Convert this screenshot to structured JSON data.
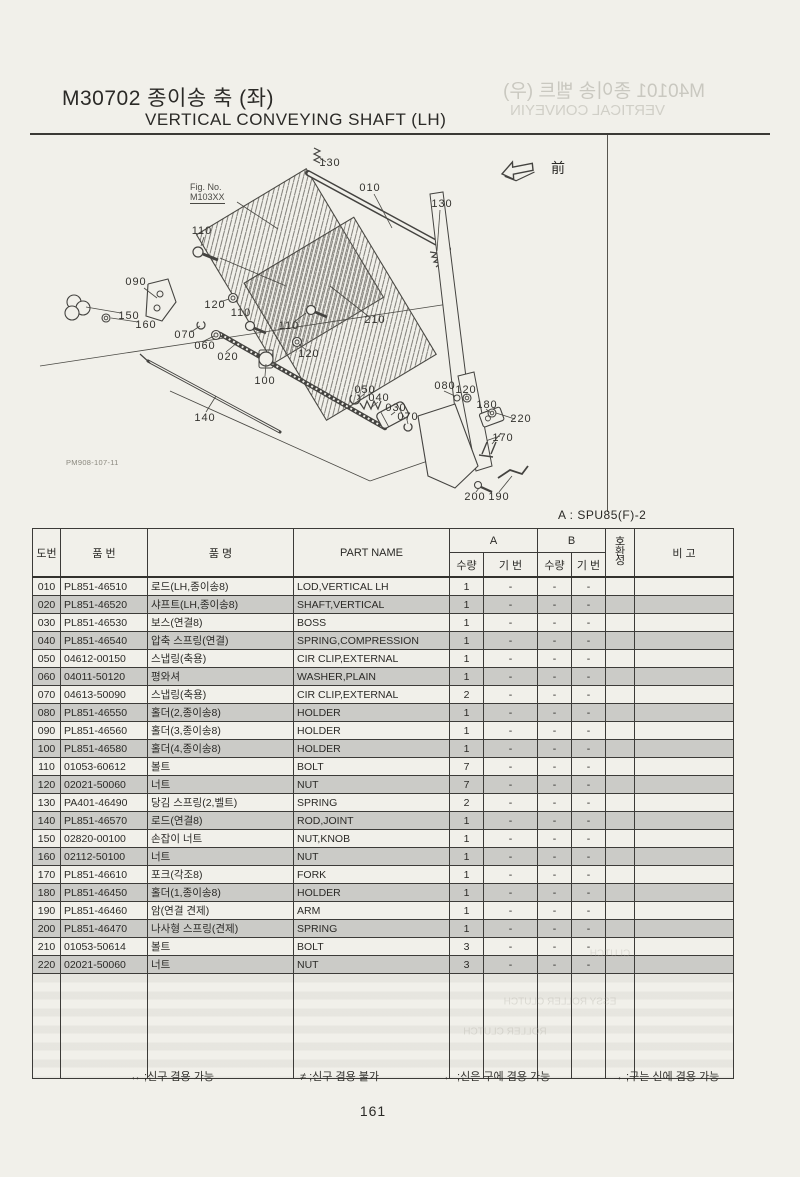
{
  "header": {
    "code_title": "M30702 종이송 축 (좌)",
    "subtitle": "VERTICAL CONVEYING SHAFT (LH)"
  },
  "ghost": {
    "title": "M40101 종이송 벨트 (우)",
    "subtitle": "VERTICAL CONVEYIN",
    "table_snippets": [
      {
        "text": "ESSY ROLLER CLUTCH",
        "x": 560,
        "y": 1002
      },
      {
        "text": "CLUTCH",
        "x": 610,
        "y": 954
      },
      {
        "text": "ROLLER CLUTCH",
        "x": 505,
        "y": 1032
      }
    ]
  },
  "diagram": {
    "fig_no_label": "Fig. No.",
    "fig_no": "M103XX",
    "doc_code": "PM908-107-11",
    "direction_label": "前",
    "callouts": [
      {
        "label": "130",
        "x": 300,
        "y": 27
      },
      {
        "label": "010",
        "x": 340,
        "y": 52
      },
      {
        "label": "130",
        "x": 412,
        "y": 68
      },
      {
        "label": "110",
        "x": 172,
        "y": 95
      },
      {
        "label": "090",
        "x": 106,
        "y": 146
      },
      {
        "label": "120",
        "x": 185,
        "y": 169
      },
      {
        "label": "110",
        "x": 211,
        "y": 177
      },
      {
        "label": "150",
        "x": 99,
        "y": 180
      },
      {
        "label": "160",
        "x": 116,
        "y": 189
      },
      {
        "label": "070",
        "x": 155,
        "y": 199
      },
      {
        "label": "110",
        "x": 259,
        "y": 190
      },
      {
        "label": "060",
        "x": 175,
        "y": 210
      },
      {
        "label": "210",
        "x": 345,
        "y": 184
      },
      {
        "label": "020",
        "x": 198,
        "y": 221
      },
      {
        "label": "120",
        "x": 279,
        "y": 218
      },
      {
        "label": "100",
        "x": 235,
        "y": 245
      },
      {
        "label": "140",
        "x": 175,
        "y": 282
      },
      {
        "label": "050",
        "x": 335,
        "y": 254
      },
      {
        "label": "040",
        "x": 349,
        "y": 262
      },
      {
        "label": "030",
        "x": 366,
        "y": 272
      },
      {
        "label": "070",
        "x": 378,
        "y": 281
      },
      {
        "label": "080",
        "x": 415,
        "y": 250
      },
      {
        "label": "120",
        "x": 436,
        "y": 254
      },
      {
        "label": "180",
        "x": 457,
        "y": 269
      },
      {
        "label": "220",
        "x": 491,
        "y": 283
      },
      {
        "label": "170",
        "x": 473,
        "y": 302
      },
      {
        "label": "200",
        "x": 445,
        "y": 361
      },
      {
        "label": "190",
        "x": 469,
        "y": 361
      }
    ]
  },
  "table": {
    "variant_note": "A : SPU85(F)-2",
    "headers": {
      "no": "도번",
      "part_no": "품 번",
      "name_kr": "품 명",
      "part_name": "PART NAME",
      "col_a": "A",
      "col_b": "B",
      "qty": "수량",
      "ref": "기 번",
      "compat_chars": [
        "호",
        "환",
        "성"
      ],
      "remark": "비 고"
    },
    "rows": [
      {
        "no": "010",
        "part_no": "PL851-46510",
        "name_kr": "로드(LH,종이송8)",
        "part_name": "LOD,VERTICAL LH",
        "a_qty": "1",
        "a_ref": "-",
        "b_qty": "-",
        "b_ref": "-",
        "compat": "",
        "remark": ""
      },
      {
        "no": "020",
        "part_no": "PL851-46520",
        "name_kr": "샤프트(LH,종이송8)",
        "part_name": "SHAFT,VERTICAL",
        "a_qty": "1",
        "a_ref": "-",
        "b_qty": "-",
        "b_ref": "-",
        "compat": "",
        "remark": ""
      },
      {
        "no": "030",
        "part_no": "PL851-46530",
        "name_kr": "보스(연결8)",
        "part_name": "BOSS",
        "a_qty": "1",
        "a_ref": "-",
        "b_qty": "-",
        "b_ref": "-",
        "compat": "",
        "remark": ""
      },
      {
        "no": "040",
        "part_no": "PL851-46540",
        "name_kr": "압축 스프링(연결)",
        "part_name": "SPRING,COMPRESSION",
        "a_qty": "1",
        "a_ref": "-",
        "b_qty": "-",
        "b_ref": "-",
        "compat": "",
        "remark": ""
      },
      {
        "no": "050",
        "part_no": "04612-00150",
        "name_kr": "스냅링(축용)",
        "part_name": "CIR CLIP,EXTERNAL",
        "a_qty": "1",
        "a_ref": "-",
        "b_qty": "-",
        "b_ref": "-",
        "compat": "",
        "remark": ""
      },
      {
        "no": "060",
        "part_no": "04011-50120",
        "name_kr": "평와셔",
        "part_name": "WASHER,PLAIN",
        "a_qty": "1",
        "a_ref": "-",
        "b_qty": "-",
        "b_ref": "-",
        "compat": "",
        "remark": ""
      },
      {
        "no": "070",
        "part_no": "04613-50090",
        "name_kr": "스냅링(축용)",
        "part_name": "CIR CLIP,EXTERNAL",
        "a_qty": "2",
        "a_ref": "-",
        "b_qty": "-",
        "b_ref": "-",
        "compat": "",
        "remark": ""
      },
      {
        "no": "080",
        "part_no": "PL851-46550",
        "name_kr": "홀더(2,종이송8)",
        "part_name": "HOLDER",
        "a_qty": "1",
        "a_ref": "-",
        "b_qty": "-",
        "b_ref": "-",
        "compat": "",
        "remark": ""
      },
      {
        "no": "090",
        "part_no": "PL851-46560",
        "name_kr": "홀더(3,종이송8)",
        "part_name": "HOLDER",
        "a_qty": "1",
        "a_ref": "-",
        "b_qty": "-",
        "b_ref": "-",
        "compat": "",
        "remark": ""
      },
      {
        "no": "100",
        "part_no": "PL851-46580",
        "name_kr": "홀더(4,종이송8)",
        "part_name": "HOLDER",
        "a_qty": "1",
        "a_ref": "-",
        "b_qty": "-",
        "b_ref": "-",
        "compat": "",
        "remark": ""
      },
      {
        "no": "110",
        "part_no": "01053-60612",
        "name_kr": "볼트",
        "part_name": "BOLT",
        "a_qty": "7",
        "a_ref": "-",
        "b_qty": "-",
        "b_ref": "-",
        "compat": "",
        "remark": ""
      },
      {
        "no": "120",
        "part_no": "02021-50060",
        "name_kr": "너트",
        "part_name": "NUT",
        "a_qty": "7",
        "a_ref": "-",
        "b_qty": "-",
        "b_ref": "-",
        "compat": "",
        "remark": ""
      },
      {
        "no": "130",
        "part_no": "PA401-46490",
        "name_kr": "당김 스프링(2,벨트)",
        "part_name": "SPRING",
        "a_qty": "2",
        "a_ref": "-",
        "b_qty": "-",
        "b_ref": "-",
        "compat": "",
        "remark": ""
      },
      {
        "no": "140",
        "part_no": "PL851-46570",
        "name_kr": "로드(연결8)",
        "part_name": "ROD,JOINT",
        "a_qty": "1",
        "a_ref": "-",
        "b_qty": "-",
        "b_ref": "-",
        "compat": "",
        "remark": ""
      },
      {
        "no": "150",
        "part_no": "02820-00100",
        "name_kr": "손잡이 너트",
        "part_name": "NUT,KNOB",
        "a_qty": "1",
        "a_ref": "-",
        "b_qty": "-",
        "b_ref": "-",
        "compat": "",
        "remark": ""
      },
      {
        "no": "160",
        "part_no": "02112-50100",
        "name_kr": "너트",
        "part_name": "NUT",
        "a_qty": "1",
        "a_ref": "-",
        "b_qty": "-",
        "b_ref": "-",
        "compat": "",
        "remark": ""
      },
      {
        "no": "170",
        "part_no": "PL851-46610",
        "name_kr": "포크(각조8)",
        "part_name": "FORK",
        "a_qty": "1",
        "a_ref": "-",
        "b_qty": "-",
        "b_ref": "-",
        "compat": "",
        "remark": ""
      },
      {
        "no": "180",
        "part_no": "PL851-46450",
        "name_kr": "홀더(1,종이송8)",
        "part_name": "HOLDER",
        "a_qty": "1",
        "a_ref": "-",
        "b_qty": "-",
        "b_ref": "-",
        "compat": "",
        "remark": ""
      },
      {
        "no": "190",
        "part_no": "PL851-46460",
        "name_kr": "암(연결 견제)",
        "part_name": "ARM",
        "a_qty": "1",
        "a_ref": "-",
        "b_qty": "-",
        "b_ref": "-",
        "compat": "",
        "remark": ""
      },
      {
        "no": "200",
        "part_no": "PL851-46470",
        "name_kr": "나사형 스프링(견제)",
        "part_name": "SPRING",
        "a_qty": "1",
        "a_ref": "-",
        "b_qty": "-",
        "b_ref": "-",
        "compat": "",
        "remark": ""
      },
      {
        "no": "210",
        "part_no": "01053-50614",
        "name_kr": "볼트",
        "part_name": "BOLT",
        "a_qty": "3",
        "a_ref": "-",
        "b_qty": "-",
        "b_ref": "-",
        "compat": "",
        "remark": ""
      },
      {
        "no": "220",
        "part_no": "02021-50060",
        "name_kr": "너트",
        "part_name": "NUT",
        "a_qty": "3",
        "a_ref": "-",
        "b_qty": "-",
        "b_ref": "-",
        "compat": "",
        "remark": ""
      }
    ]
  },
  "footer": {
    "legend": [
      "↔ ;신구 겸용 가능",
      "≠ ;신구 겸용 불가",
      "← ;신은 구에 겸용 가능",
      "→ ;구는 신에 겸용 가능"
    ],
    "page_number": "161"
  }
}
